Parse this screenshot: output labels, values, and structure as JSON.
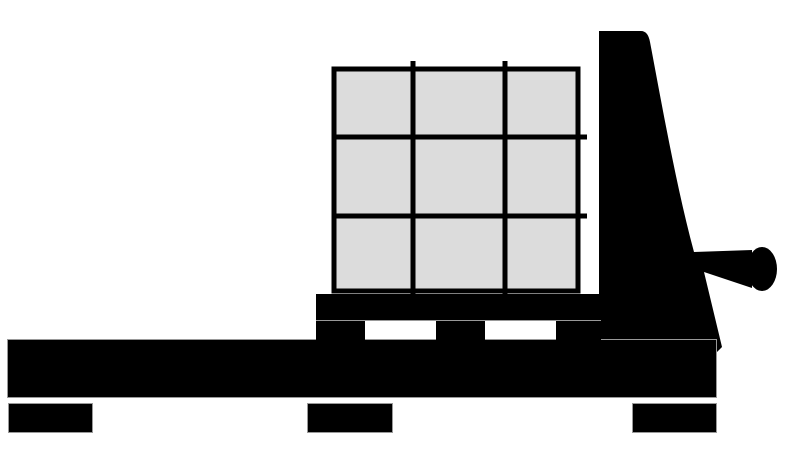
{
  "illustration": {
    "subject": "pallet-truck-with-boxes-clipart",
    "background_color": "#FFFFFF",
    "silhouette_color": "#000000",
    "box_fill_color": "#DCDCDC",
    "grid_line_color": "#000000",
    "outline_color": "#999999",
    "box_grid": {
      "rows": "3",
      "columns": "3"
    }
  }
}
